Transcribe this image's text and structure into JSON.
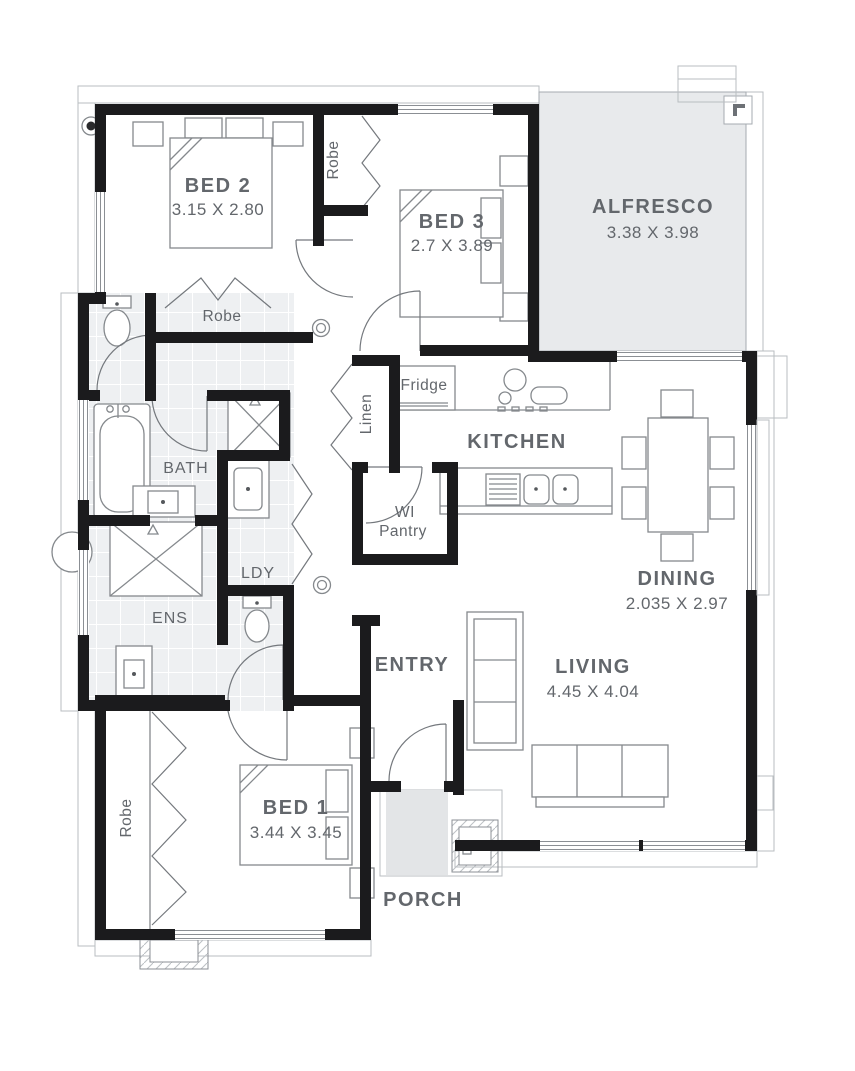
{
  "floorplan": {
    "rooms": {
      "bed2": {
        "label": "BED 2",
        "dims": "3.15 X 2.80"
      },
      "bed3": {
        "label": "BED 3",
        "dims": "2.7 X 3.89"
      },
      "bed1": {
        "label": "BED 1",
        "dims": "3.44 X 3.45"
      },
      "alfresco": {
        "label": "ALFRESCO",
        "dims": "3.38 X 3.98"
      },
      "kitchen": {
        "label": "KITCHEN"
      },
      "dining": {
        "label": "DINING",
        "dims": "2.035 X 2.97"
      },
      "living": {
        "label": "LIVING",
        "dims": "4.45 X 4.04"
      },
      "entry": {
        "label": "ENTRY"
      },
      "porch": {
        "label": "PORCH"
      },
      "bath": {
        "label": "BATH"
      },
      "ens": {
        "label": "ENS"
      },
      "laundry": {
        "label": "LDY"
      },
      "pantry": {
        "label_line1": "WI",
        "label_line2": "Pantry"
      }
    },
    "storage": {
      "robe_bed3": {
        "label": "Robe"
      },
      "robe_bed2": {
        "label": "Robe"
      },
      "robe_bed1": {
        "label": "Robe"
      },
      "linen": {
        "label": "Linen"
      }
    },
    "appliances": {
      "fridge": {
        "label": "Fridge"
      }
    },
    "colors": {
      "wall": "#1b1b1d",
      "label_text": "#63676c",
      "alfresco_fill": "#e8eaec",
      "porch_fill": "#e3e5e7",
      "tile_fill": "#eef0f2",
      "fixture_line": "#85898d"
    }
  }
}
